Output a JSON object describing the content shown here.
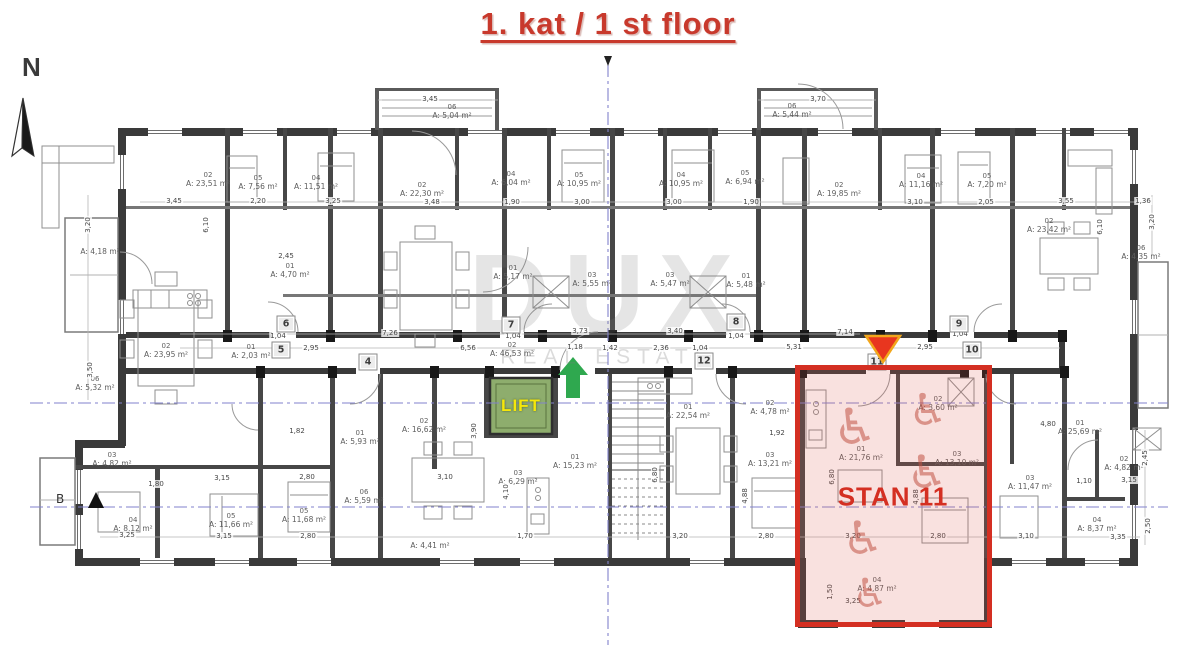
{
  "title": "1. kat / 1 st floor",
  "compass_letter": "N",
  "section_marker": "B",
  "watermark": {
    "brand": "DUX",
    "tagline": "REAL ESTATE"
  },
  "lift_label": "LIFT",
  "stan_label": "STAN 11",
  "colors": {
    "title_red": "#c8392c",
    "stan_red": "#d42f22",
    "stan_fill": "rgba(224,90,78,0.18)",
    "lift_green": "#8ead6d",
    "lift_yellow": "#f6e70a",
    "arrow_green": "#2fa84f",
    "axis_blue": "#8282cc",
    "wall": "#3a3a3a"
  },
  "room_labels": [
    {
      "id": "02",
      "area": "A: 23,51 m²",
      "x": 208,
      "y": 180
    },
    {
      "id": "05",
      "area": "A: 7,56 m²",
      "x": 258,
      "y": 183
    },
    {
      "id": "04",
      "area": "A: 11,51 m²",
      "x": 316,
      "y": 183
    },
    {
      "id": "06",
      "area": "A: 5,04 m²",
      "x": 452,
      "y": 112
    },
    {
      "id": "02",
      "area": "A: 22,30 m²",
      "x": 422,
      "y": 190
    },
    {
      "id": "04",
      "area": "A: 6,04 m²",
      "x": 511,
      "y": 179
    },
    {
      "id": "05",
      "area": "A: 10,95 m²",
      "x": 579,
      "y": 180
    },
    {
      "id": "04",
      "area": "A: 10,95 m²",
      "x": 681,
      "y": 180
    },
    {
      "id": "06",
      "area": "A: 5,44 m²",
      "x": 792,
      "y": 111
    },
    {
      "id": "05",
      "area": "A: 6,94 m²",
      "x": 745,
      "y": 178
    },
    {
      "id": "02",
      "area": "A: 19,85 m²",
      "x": 839,
      "y": 190
    },
    {
      "id": "04",
      "area": "A: 11,16 m²",
      "x": 921,
      "y": 181
    },
    {
      "id": "05",
      "area": "A: 7,20 m²",
      "x": 987,
      "y": 181
    },
    {
      "id": "02",
      "area": "A: 23,42 m²",
      "x": 1049,
      "y": 226
    },
    {
      "id": "",
      "area": "A: 4,18 m²",
      "x": 100,
      "y": 252
    },
    {
      "id": "06",
      "area": "A: 4,35 m²",
      "x": 1141,
      "y": 253
    },
    {
      "id": "01",
      "area": "A: 5,17 m²",
      "x": 513,
      "y": 273
    },
    {
      "id": "03",
      "area": "A: 5,55 m²",
      "x": 592,
      "y": 280
    },
    {
      "id": "03",
      "area": "A: 5,47 m²",
      "x": 670,
      "y": 280
    },
    {
      "id": "01",
      "area": "A: 5,48 m²",
      "x": 746,
      "y": 281
    },
    {
      "id": "01",
      "area": "A: 4,70 m²",
      "x": 290,
      "y": 271
    },
    {
      "id": "02",
      "area": "A: 46,53 m²",
      "x": 512,
      "y": 350
    },
    {
      "id": "02",
      "area": "A: 23,95 m²",
      "x": 166,
      "y": 351
    },
    {
      "id": "01",
      "area": "A: 2,03 m²",
      "x": 251,
      "y": 352
    },
    {
      "id": "06",
      "area": "A: 5,32 m²",
      "x": 95,
      "y": 384
    },
    {
      "id": "03",
      "area": "A: 4,82 m²",
      "x": 112,
      "y": 460
    },
    {
      "id": "04",
      "area": "A: 8,12 m²",
      "x": 133,
      "y": 525
    },
    {
      "id": "05",
      "area": "A: 11,66 m²",
      "x": 231,
      "y": 521
    },
    {
      "id": "05",
      "area": "A: 11,68 m²",
      "x": 304,
      "y": 516
    },
    {
      "id": "01",
      "area": "A: 5,93 m²",
      "x": 360,
      "y": 438
    },
    {
      "id": "06",
      "area": "A: 5,59 m²",
      "x": 364,
      "y": 497
    },
    {
      "id": "02",
      "area": "A: 16,62 m²",
      "x": 424,
      "y": 426
    },
    {
      "id": "03",
      "area": "A: 6,29 m²",
      "x": 518,
      "y": 478
    },
    {
      "id": "01",
      "area": "A: 15,23 m²",
      "x": 575,
      "y": 462
    },
    {
      "id": "",
      "area": "A: 4,41 m²",
      "x": 430,
      "y": 546
    },
    {
      "id": "01",
      "area": "A: 22,54 m²",
      "x": 688,
      "y": 412
    },
    {
      "id": "02",
      "area": "A: 4,78 m²",
      "x": 770,
      "y": 408
    },
    {
      "id": "03",
      "area": "A: 13,21 m²",
      "x": 770,
      "y": 460
    },
    {
      "id": "01",
      "area": "A: 25,69 m²",
      "x": 1080,
      "y": 428
    },
    {
      "id": "02",
      "area": "A: 4,82 m²",
      "x": 1124,
      "y": 464
    },
    {
      "id": "03",
      "area": "A: 11,47 m²",
      "x": 1030,
      "y": 483
    },
    {
      "id": "04",
      "area": "A: 8,37 m²",
      "x": 1097,
      "y": 525
    },
    {
      "id": "01",
      "area": "A: 21,76 m²",
      "x": 861,
      "y": 454
    },
    {
      "id": "02",
      "area": "A: 3,60 m²",
      "x": 938,
      "y": 404
    },
    {
      "id": "03",
      "area": "A: 13,10 m²",
      "x": 957,
      "y": 459
    },
    {
      "id": "04",
      "area": "A: 4,87 m²",
      "x": 877,
      "y": 585
    }
  ],
  "dim_labels": [
    {
      "t": "3,45",
      "x": 174,
      "y": 201
    },
    {
      "t": "2,20",
      "x": 258,
      "y": 201
    },
    {
      "t": "3,25",
      "x": 333,
      "y": 201
    },
    {
      "t": "3,45",
      "x": 430,
      "y": 99
    },
    {
      "t": "3,48",
      "x": 432,
      "y": 202
    },
    {
      "t": "1,90",
      "x": 512,
      "y": 202
    },
    {
      "t": "3,00",
      "x": 582,
      "y": 202
    },
    {
      "t": "3,00",
      "x": 674,
      "y": 202
    },
    {
      "t": "3,70",
      "x": 818,
      "y": 99
    },
    {
      "t": "1,90",
      "x": 751,
      "y": 202
    },
    {
      "t": "3,10",
      "x": 915,
      "y": 202
    },
    {
      "t": "2,05",
      "x": 986,
      "y": 202
    },
    {
      "t": "3,55",
      "x": 1066,
      "y": 201
    },
    {
      "t": "1,36",
      "x": 1143,
      "y": 201
    },
    {
      "t": "2,45",
      "x": 286,
      "y": 256
    },
    {
      "t": "6,10",
      "x": 206,
      "y": 225,
      "rot": -90
    },
    {
      "t": "6,10",
      "x": 1100,
      "y": 227,
      "rot": -90
    },
    {
      "t": "3,20",
      "x": 88,
      "y": 225,
      "rot": -90
    },
    {
      "t": "3,50",
      "x": 90,
      "y": 370,
      "rot": -90
    },
    {
      "t": "3,20",
      "x": 1152,
      "y": 222,
      "rot": -90
    },
    {
      "t": "7,26",
      "x": 390,
      "y": 333
    },
    {
      "t": "2,95",
      "x": 311,
      "y": 348
    },
    {
      "t": "6,56",
      "x": 468,
      "y": 348
    },
    {
      "t": "1,04",
      "x": 278,
      "y": 336
    },
    {
      "t": "1,04",
      "x": 513,
      "y": 336
    },
    {
      "t": "1,04",
      "x": 736,
      "y": 336
    },
    {
      "t": "3,73",
      "x": 580,
      "y": 331
    },
    {
      "t": "3,40",
      "x": 675,
      "y": 331
    },
    {
      "t": "1,18",
      "x": 575,
      "y": 347
    },
    {
      "t": "1,42",
      "x": 610,
      "y": 348
    },
    {
      "t": "2,36",
      "x": 661,
      "y": 348
    },
    {
      "t": "1,04",
      "x": 700,
      "y": 348
    },
    {
      "t": "7,14",
      "x": 845,
      "y": 332
    },
    {
      "t": "5,31",
      "x": 794,
      "y": 347
    },
    {
      "t": "2,95",
      "x": 925,
      "y": 347
    },
    {
      "t": "1,04",
      "x": 960,
      "y": 334
    },
    {
      "t": "3,15",
      "x": 222,
      "y": 478
    },
    {
      "t": "2,80",
      "x": 307,
      "y": 477
    },
    {
      "t": "1,80",
      "x": 156,
      "y": 484
    },
    {
      "t": "1,82",
      "x": 297,
      "y": 431
    },
    {
      "t": "3,25",
      "x": 127,
      "y": 535
    },
    {
      "t": "3,15",
      "x": 224,
      "y": 536
    },
    {
      "t": "2,80",
      "x": 308,
      "y": 536
    },
    {
      "t": "3,10",
      "x": 445,
      "y": 477
    },
    {
      "t": "1,70",
      "x": 525,
      "y": 536
    },
    {
      "t": "3,20",
      "x": 680,
      "y": 536
    },
    {
      "t": "2,80",
      "x": 766,
      "y": 536
    },
    {
      "t": "1,92",
      "x": 777,
      "y": 433
    },
    {
      "t": "3,20",
      "x": 853,
      "y": 536
    },
    {
      "t": "2,80",
      "x": 938,
      "y": 536
    },
    {
      "t": "3,25",
      "x": 853,
      "y": 601
    },
    {
      "t": "4,80",
      "x": 1048,
      "y": 424
    },
    {
      "t": "1,10",
      "x": 1084,
      "y": 481
    },
    {
      "t": "3,15",
      "x": 1129,
      "y": 480
    },
    {
      "t": "3,10",
      "x": 1026,
      "y": 536
    },
    {
      "t": "3,35",
      "x": 1118,
      "y": 537
    },
    {
      "t": "4,10",
      "x": 506,
      "y": 492,
      "rot": -90
    },
    {
      "t": "3,90",
      "x": 474,
      "y": 431,
      "rot": -90
    },
    {
      "t": "6,80",
      "x": 655,
      "y": 475,
      "rot": -90
    },
    {
      "t": "6,80",
      "x": 832,
      "y": 477,
      "rot": -90
    },
    {
      "t": "4,88",
      "x": 745,
      "y": 496,
      "rot": -90
    },
    {
      "t": "4,88",
      "x": 916,
      "y": 497,
      "rot": -90
    },
    {
      "t": "2,45",
      "x": 1145,
      "y": 458,
      "rot": -90
    },
    {
      "t": "2,50",
      "x": 1148,
      "y": 526,
      "rot": -90
    },
    {
      "t": "1,50",
      "x": 830,
      "y": 592,
      "rot": -90
    }
  ],
  "door_numbers": [
    {
      "n": "6",
      "x": 286,
      "y": 324
    },
    {
      "n": "5",
      "x": 281,
      "y": 350
    },
    {
      "n": "4",
      "x": 368,
      "y": 362
    },
    {
      "n": "7",
      "x": 511,
      "y": 325
    },
    {
      "n": "8",
      "x": 736,
      "y": 322
    },
    {
      "n": "9",
      "x": 959,
      "y": 324
    },
    {
      "n": "10",
      "x": 972,
      "y": 350
    },
    {
      "n": "12",
      "x": 704,
      "y": 361
    },
    {
      "n": "11",
      "x": 877,
      "y": 362
    }
  ],
  "wheelchairs": [
    {
      "glyph": "♿",
      "x": 855,
      "y": 427,
      "s": 50
    },
    {
      "glyph": "♿",
      "x": 928,
      "y": 411,
      "s": 44
    },
    {
      "glyph": "♿",
      "x": 927,
      "y": 472,
      "s": 46
    },
    {
      "glyph": "♿",
      "x": 863,
      "y": 538,
      "s": 46
    },
    {
      "glyph": "♿",
      "x": 870,
      "y": 594,
      "s": 40
    }
  ]
}
